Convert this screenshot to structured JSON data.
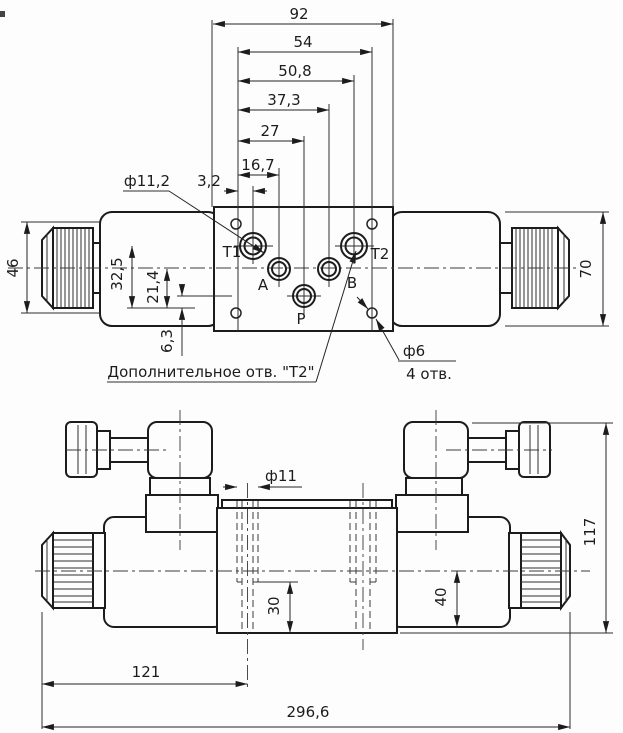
{
  "drawing": {
    "kind": "hydraulic directional valve dimensional drawing",
    "colors": {
      "background": "#fdfdfd",
      "line": "#1c1c1c"
    }
  },
  "top_view": {
    "chain_dims": [
      "92",
      "54",
      "50,8",
      "37,3",
      "27",
      "16,7",
      "3,2"
    ],
    "left_dims": [
      "46",
      "32,5",
      "21,4",
      "6,3"
    ],
    "right_dim": "70",
    "ports": [
      "T1",
      "A",
      "P",
      "B",
      "T2"
    ],
    "callout_port_dia": "ф11,2",
    "callout_hole_dia": "ф6",
    "callout_hole_count": "4 отв.",
    "note_extra_port": "Дополнительное отв. \"Т2\""
  },
  "bottom_view": {
    "hole_dia": "ф11",
    "hole_depth": "30",
    "axis_to_bottom": "40",
    "overall_height": "117",
    "knob_to_hole_axis": "121",
    "overall_length": "296,6"
  }
}
